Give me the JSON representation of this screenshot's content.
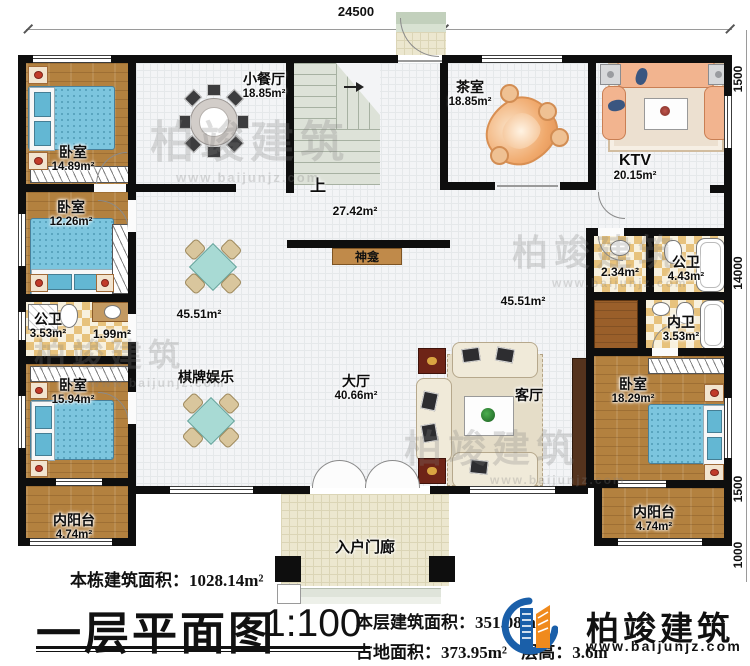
{
  "dimensions": {
    "top": "24500",
    "right": [
      "1500",
      "14000",
      "1500",
      "1000"
    ]
  },
  "rooms": {
    "bedroom1": {
      "name": "卧室",
      "area": "14.89m²"
    },
    "bedroom2": {
      "name": "卧室",
      "area": "12.26m²"
    },
    "bath_left": {
      "name": "公卫",
      "area": "3.53m²"
    },
    "wash_lobby": {
      "area": "1.99m²"
    },
    "bedroom3": {
      "name": "卧室",
      "area": "15.94m²"
    },
    "balcony_left": {
      "name": "内阳台",
      "area": "4.74m²"
    },
    "dining": {
      "name": "小餐厅",
      "area": "18.85m²"
    },
    "stairs": {
      "up": "上"
    },
    "tea": {
      "name": "茶室",
      "area": "18.85m²"
    },
    "ktv": {
      "name": "KTV",
      "area": "20.15m²"
    },
    "corridor": {
      "area": "27.42m²"
    },
    "shrine": {
      "name": "神龛"
    },
    "open_left": {
      "area": "45.51m²"
    },
    "open_right": {
      "area": "45.51m²"
    },
    "wash_right": {
      "area": "2.34m²"
    },
    "bath_right": {
      "name": "公卫",
      "area": "4.43m²"
    },
    "ensuite": {
      "name": "内卫",
      "area": "3.53m²"
    },
    "games": {
      "name": "棋牌娱乐"
    },
    "hall": {
      "name": "大厅",
      "area": "40.66m²"
    },
    "living": {
      "name": "客厅"
    },
    "bedroom4": {
      "name": "卧室",
      "area": "18.29m²"
    },
    "balcony_right": {
      "name": "内阳台",
      "area": "4.74m²"
    },
    "porch": {
      "name": "入户门廊"
    }
  },
  "footer": {
    "total_area_label": "本栋建筑面积：",
    "total_area_value": "1028.14m²",
    "title": "一层平面图",
    "scale": "1:100",
    "floor_area_label": "本层建筑面积：",
    "floor_area_value": "351.08m²",
    "land_area_label": "占地面积：",
    "land_area_value": "373.95m²",
    "height_label": "层高：",
    "height_value": "3.6m",
    "brand_name": "柏竣建筑",
    "brand_url": "www.baijunjz.com"
  },
  "watermark": {
    "text": "柏竣建筑",
    "url": "www.baijunjz.com"
  },
  "colors": {
    "wall": "#0e0e0e",
    "wood": "#b3813f",
    "bed": "#7cc5de",
    "tile": "#e7c27c",
    "brand_blue": "#1a5fa9",
    "brand_orange": "#f08a1d"
  }
}
